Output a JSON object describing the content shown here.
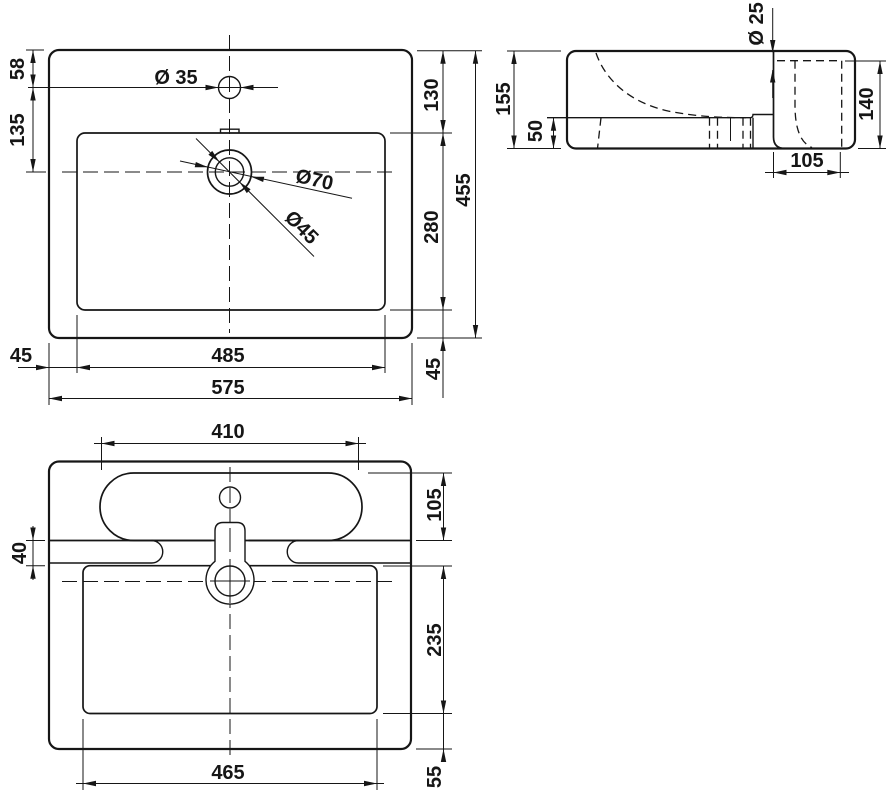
{
  "meta": {
    "drawing_type": "technical dimensional drawing",
    "subject": "washbasin three-view drawing",
    "line_color": "#161616",
    "background_color": "#ffffff"
  },
  "views": {
    "top": {
      "label": "top view",
      "dims": {
        "d58": "58",
        "d135": "135",
        "d35": "Ø 35",
        "d70": "Ø70",
        "d45_drain": "Ø45",
        "d130": "130",
        "d280": "280",
        "d455": "455",
        "d45_left": "45",
        "d485": "485",
        "d575": "575",
        "d45_right": "45"
      }
    },
    "side": {
      "label": "side section view",
      "dims": {
        "d25": "Ø 25",
        "d155": "155",
        "d50": "50",
        "d140": "140",
        "d105": "105"
      }
    },
    "bottom": {
      "label": "bottom view",
      "dims": {
        "d410": "410",
        "d105": "105",
        "d40": "40",
        "d235": "235",
        "d465": "465",
        "d55": "55"
      }
    }
  }
}
